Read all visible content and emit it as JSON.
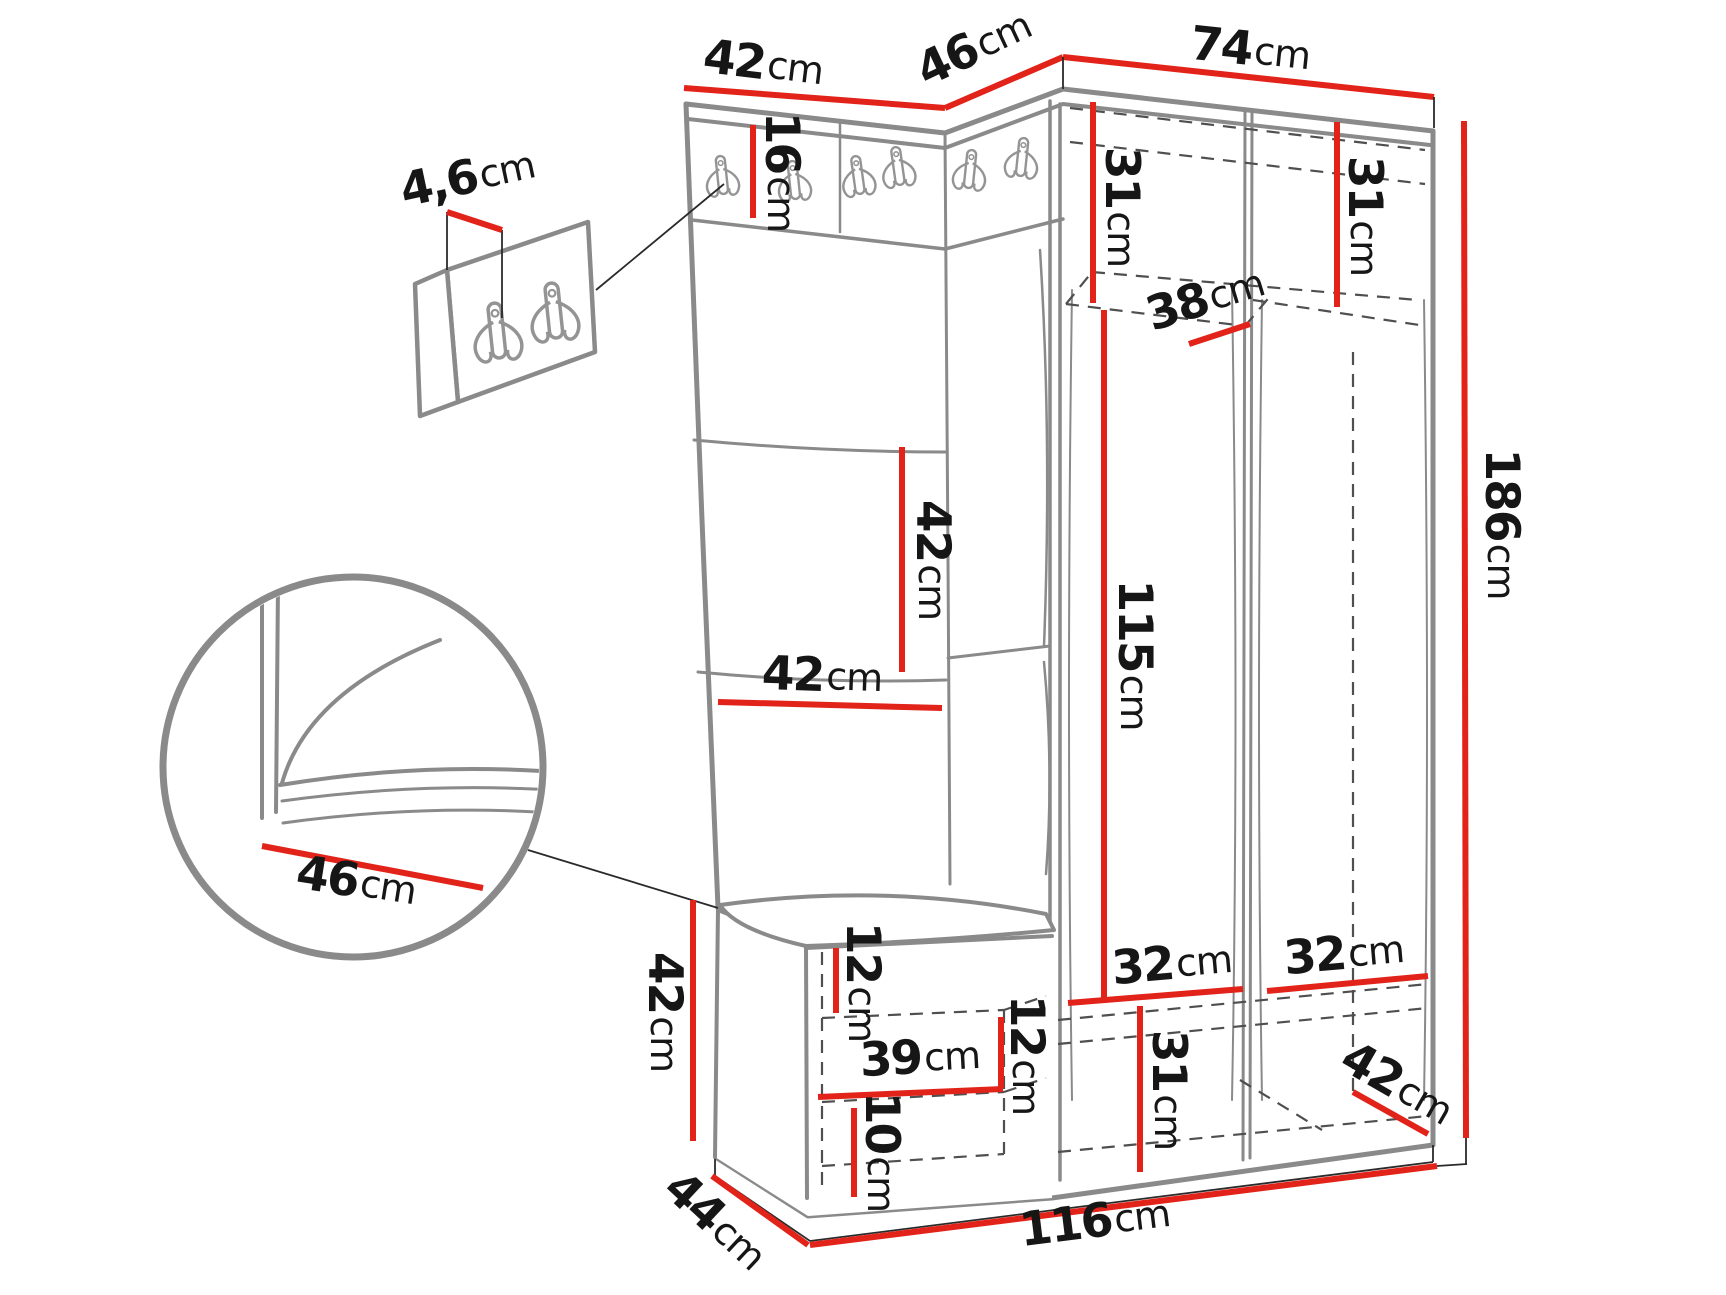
{
  "palette": {
    "dimension_red": "#e2231a",
    "outline_gray": "#8a8a8a",
    "dashed_gray": "#4f4f4f",
    "label_black": "#161616",
    "background": "#ffffff"
  },
  "icons": {
    "coat_hook": "double-prong-wall-hook"
  },
  "dims": {
    "top_width_left": {
      "value": "42",
      "unit": "cm"
    },
    "top_width_corner": {
      "value": "46",
      "unit": "cm"
    },
    "top_width_wardrobe": {
      "value": "74",
      "unit": "cm"
    },
    "hook_rail_height": {
      "value": "16",
      "unit": "cm"
    },
    "hook_panel_thickness": {
      "value": "4,6",
      "unit": "cm"
    },
    "top_shelf_left_height": {
      "value": "31",
      "unit": "cm"
    },
    "top_shelf_right_height": {
      "value": "31",
      "unit": "cm"
    },
    "top_shelf_depth": {
      "value": "38",
      "unit": "cm"
    },
    "hanging_height": {
      "value": "115",
      "unit": "cm"
    },
    "total_height": {
      "value": "186",
      "unit": "cm"
    },
    "panel_tile_height": {
      "value": "42",
      "unit": "cm"
    },
    "panel_tile_width": {
      "value": "42",
      "unit": "cm"
    },
    "bench_height": {
      "value": "42",
      "unit": "cm"
    },
    "seat_depth_detail": {
      "value": "46",
      "unit": "cm"
    },
    "bench_opening_top": {
      "value": "12",
      "unit": "cm"
    },
    "bench_shelf_width": {
      "value": "39",
      "unit": "cm"
    },
    "bench_opening_right": {
      "value": "12",
      "unit": "cm"
    },
    "bench_opening_bottom": {
      "value": "10",
      "unit": "cm"
    },
    "bottom_shelf_left_width": {
      "value": "32",
      "unit": "cm"
    },
    "bottom_shelf_right_width": {
      "value": "32",
      "unit": "cm"
    },
    "bottom_shelf_height": {
      "value": "31",
      "unit": "cm"
    },
    "depth_right": {
      "value": "42",
      "unit": "cm"
    },
    "depth_left": {
      "value": "44",
      "unit": "cm"
    },
    "total_width": {
      "value": "116",
      "unit": "cm"
    }
  }
}
